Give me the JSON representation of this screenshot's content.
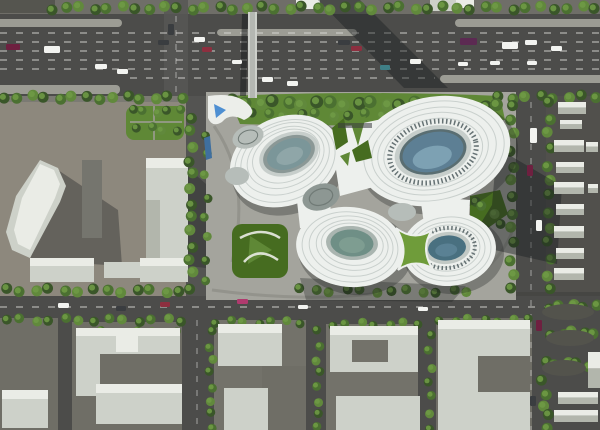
{
  "meta": {
    "description": "Aerial architectural rendering: white organic blob-shaped cultural complex with oval glass skylights, surrounded by highway, tree-lined streets and gray city-block massing models",
    "width": 600,
    "height": 430
  },
  "palette": {
    "asphalt": "#4c4c4a",
    "asphaltLight": "#575755",
    "roadMid": "#545452",
    "sidewalk": "#7b7a73",
    "topStrip": "#6f6e68",
    "sidewalkDark": "#55554f",
    "median": "#9c9c94",
    "laneWhite": "#dedddb",
    "lotLeft": "#8d887d",
    "sitePlaza": "#a4a49d",
    "sitePath": "#8f8f88",
    "lotRight": "#51504c",
    "curvyBase": "#464643",
    "islet": "#53534c",
    "blockGround": "#6f6e66",
    "blockGround2": "#73726a",
    "bldgBody": "#cdd1c9",
    "bldgTop": "#eaece6",
    "bldgSide": "#b2b6ac",
    "bldgDark": "#75756e",
    "treeDark": "#3a5629",
    "treeMid": "#4b7031",
    "treeLight": "#61893c",
    "treeCore": "#6f9a45",
    "lawn": "#5f8836",
    "lawnDark": "#466c20",
    "lawnBright": "#6f9c3a",
    "blobWhite": "#edf0ed",
    "blobRib": "#c6cdca",
    "blobRibDark": "#a7b0ae",
    "blobShade": "#8e9997",
    "domeGray": "#b6bdb9",
    "domeDark": "#8d9793",
    "domeRib": "#707a76",
    "eyeRim1": "#8b9896",
    "eyeGlass1": "#7b9699",
    "eyeHi1": "#93a9aa",
    "eyeRing2": "#c7cecb",
    "eyeRim2": "#5a6e72",
    "eyeGlass2": "#5d7f94",
    "eyeHi2": "#83a7b8",
    "dotRing": "#667274",
    "eyeRim3": "#aab5b0",
    "eyeGlass3": "#6f8f86",
    "eyeHi3": "#82a093",
    "eyeRim4": "#c2c9c5",
    "eyeGlass4": "#497080",
    "eyeHi4": "#5f8699",
    "canopyWhite": "#eceeea",
    "water": "#4e8fd2",
    "waterDark": "#3f6f9f",
    "bridgeDeck": "#b4b7b2",
    "bridgeRail": "#e6e8e4",
    "shadow50": "rgba(20,23,25,0.50)",
    "shadow42": "rgba(25,29,31,0.42)",
    "shadow35": "rgba(25,29,31,0.35)",
    "shadow30": "rgba(25,29,31,0.30)",
    "carWhite": "#f2f3f0",
    "carDark": "#3a3d40",
    "carRed": "#8d2f3f",
    "carMaroon": "#6e2040",
    "carPurple": "#5c2a52",
    "carTeal": "#3f7f86",
    "carMagenta": "#b03a6e"
  },
  "scene": {
    "medians": [
      [
        -8,
        19,
        130,
        8
      ],
      [
        -8,
        85,
        128,
        9
      ],
      [
        217,
        29,
        140,
        7
      ],
      [
        455,
        19,
        150,
        8
      ],
      [
        440,
        75,
        166,
        8
      ]
    ],
    "lane_h": [
      [
        33,
        0,
        600
      ],
      [
        42,
        0,
        600
      ],
      [
        51,
        0,
        600
      ],
      [
        60,
        0,
        600
      ],
      [
        69,
        0,
        600
      ],
      [
        78,
        130,
        435
      ],
      [
        307,
        0,
        600
      ]
    ],
    "lane_v": [
      [
        176,
        16,
        96
      ],
      [
        531,
        102,
        292
      ],
      [
        531,
        300,
        430
      ],
      [
        197,
        320,
        428
      ]
    ],
    "tree_rows": [
      [
        52,
        8,
        596,
        8,
        40,
        5.5
      ],
      [
        4,
        97,
        182,
        98,
        14,
        5.5
      ],
      [
        498,
        97,
        596,
        97,
        8,
        5.5
      ],
      [
        232,
        102,
        498,
        105,
        20,
        6.5
      ],
      [
        252,
        114,
        478,
        116,
        15,
        5
      ],
      [
        191,
        118,
        191,
        288,
        13,
        5.5
      ],
      [
        206,
        134,
        206,
        280,
        8,
        4.5
      ],
      [
        512,
        104,
        512,
        290,
        13,
        5.5
      ],
      [
        549,
        102,
        549,
        290,
        13,
        5.5
      ],
      [
        6,
        290,
        180,
        291,
        13,
        5.5
      ],
      [
        300,
        290,
        468,
        292,
        12,
        5
      ],
      [
        6,
        320,
        182,
        320,
        13,
        5
      ],
      [
        216,
        322,
        300,
        322,
        7,
        4.5
      ],
      [
        332,
        324,
        418,
        324,
        7,
        4.5
      ],
      [
        440,
        320,
        528,
        320,
        7,
        4.5
      ],
      [
        211,
        332,
        211,
        428,
        8,
        4.5
      ],
      [
        318,
        332,
        318,
        428,
        8,
        4.5
      ],
      [
        430,
        336,
        430,
        428,
        7,
        4.5
      ],
      [
        86,
        332,
        178,
        332,
        8,
        4
      ],
      [
        548,
        307,
        596,
        305,
        5,
        5.5
      ],
      [
        552,
        334,
        594,
        332,
        5,
        5.5
      ],
      [
        545,
        362,
        588,
        365,
        5,
        5.5
      ],
      [
        543,
        382,
        548,
        428,
        5,
        5.5
      ],
      [
        132,
        111,
        180,
        111,
        5,
        4.5
      ],
      [
        138,
        128,
        176,
        130,
        4,
        4.5
      ],
      [
        474,
        200,
        502,
        222,
        4,
        5
      ]
    ],
    "cars": [
      [
        6,
        44,
        14,
        6,
        "carMaroon"
      ],
      [
        44,
        46,
        16,
        7,
        "carWhite"
      ],
      [
        95,
        64,
        12,
        5,
        "carWhite"
      ],
      [
        117,
        69,
        11,
        5,
        "carWhite"
      ],
      [
        158,
        40,
        11,
        5,
        "carDark"
      ],
      [
        194,
        37,
        11,
        5,
        "carWhite"
      ],
      [
        202,
        47,
        10,
        5,
        "carRed"
      ],
      [
        232,
        60,
        10,
        4,
        "carWhite"
      ],
      [
        262,
        77,
        11,
        5,
        "carWhite"
      ],
      [
        287,
        81,
        11,
        5,
        "carWhite"
      ],
      [
        338,
        40,
        12,
        5,
        "carDark"
      ],
      [
        351,
        46,
        11,
        5,
        "carRed"
      ],
      [
        380,
        65,
        10,
        5,
        "carTeal"
      ],
      [
        410,
        59,
        11,
        5,
        "carWhite"
      ],
      [
        460,
        38,
        17,
        7,
        "carPurple"
      ],
      [
        502,
        42,
        16,
        7,
        "carWhite"
      ],
      [
        525,
        40,
        12,
        5,
        "carWhite"
      ],
      [
        551,
        46,
        11,
        5,
        "carWhite"
      ],
      [
        458,
        62,
        10,
        4,
        "carWhite"
      ],
      [
        490,
        61,
        10,
        4,
        "carWhite"
      ],
      [
        527,
        61,
        10,
        4,
        "carWhite"
      ],
      [
        168,
        24,
        6,
        11,
        "carDark"
      ],
      [
        530,
        128,
        7,
        15,
        "carWhite"
      ],
      [
        527,
        165,
        6,
        11,
        "carMaroon"
      ],
      [
        536,
        220,
        6,
        11,
        "carWhite"
      ],
      [
        536,
        320,
        6,
        11,
        "carMaroon"
      ],
      [
        530,
        396,
        6,
        10,
        "carDark"
      ],
      [
        58,
        303,
        11,
        5,
        "carWhite"
      ],
      [
        116,
        306,
        10,
        5,
        "carDark"
      ],
      [
        160,
        302,
        10,
        5,
        "carRed"
      ],
      [
        237,
        299,
        11,
        5,
        "carMagenta"
      ],
      [
        298,
        305,
        10,
        4,
        "carWhite"
      ],
      [
        418,
        307,
        10,
        4,
        "carWhite"
      ]
    ],
    "right_lot_buildings": [
      [
        558,
        102,
        28,
        12
      ],
      [
        560,
        120,
        22,
        9
      ],
      [
        554,
        140,
        30,
        12
      ],
      [
        586,
        142,
        12,
        10
      ],
      [
        556,
        162,
        28,
        11
      ],
      [
        554,
        182,
        30,
        12
      ],
      [
        588,
        184,
        10,
        9
      ],
      [
        556,
        204,
        28,
        11
      ],
      [
        554,
        226,
        30,
        12
      ],
      [
        556,
        248,
        28,
        11
      ],
      [
        554,
        268,
        30,
        12
      ],
      [
        558,
        392,
        40,
        12
      ],
      [
        554,
        410,
        44,
        12
      ],
      [
        588,
        352,
        12,
        36
      ]
    ]
  }
}
